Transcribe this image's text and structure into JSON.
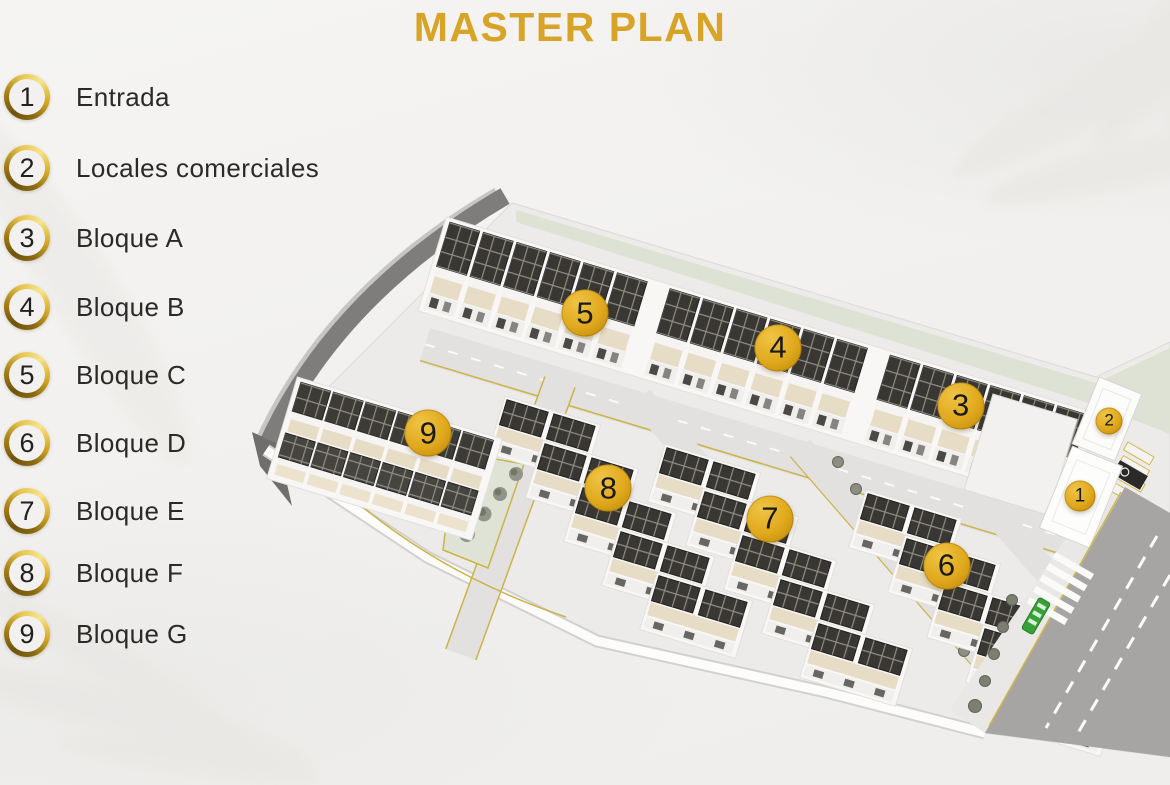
{
  "title": "MASTER PLAN",
  "legend": {
    "items": [
      {
        "number": "1",
        "label": "Entrada"
      },
      {
        "number": "2",
        "label": "Locales comerciales"
      },
      {
        "number": "3",
        "label": "Bloque A"
      },
      {
        "number": "4",
        "label": "Bloque B"
      },
      {
        "number": "5",
        "label": "Bloque C"
      },
      {
        "number": "6",
        "label": "Bloque D"
      },
      {
        "number": "7",
        "label": "Bloque E"
      },
      {
        "number": "8",
        "label": "Bloque F"
      },
      {
        "number": "9",
        "label": "Bloque G"
      }
    ]
  },
  "map": {
    "markers": [
      {
        "number": "5",
        "x_pct": 50.0,
        "y_pct": 39.9,
        "size": "large"
      },
      {
        "number": "4",
        "x_pct": 66.5,
        "y_pct": 44.3,
        "size": "large"
      },
      {
        "number": "3",
        "x_pct": 82.1,
        "y_pct": 51.7,
        "size": "large"
      },
      {
        "number": "9",
        "x_pct": 36.6,
        "y_pct": 55.2,
        "size": "large"
      },
      {
        "number": "8",
        "x_pct": 52.0,
        "y_pct": 62.2,
        "size": "large"
      },
      {
        "number": "7",
        "x_pct": 65.8,
        "y_pct": 66.1,
        "size": "large"
      },
      {
        "number": "6",
        "x_pct": 80.9,
        "y_pct": 72.1,
        "size": "large"
      },
      {
        "number": "2",
        "x_pct": 94.8,
        "y_pct": 53.6,
        "size": "small"
      },
      {
        "number": "1",
        "x_pct": 92.3,
        "y_pct": 63.2,
        "size": "medium"
      }
    ]
  },
  "colors": {
    "title_gold": "#d7a428",
    "marker_gold": "#e0ac1e",
    "legend_text": "#2b2a28",
    "background": "#f1f0ee"
  }
}
